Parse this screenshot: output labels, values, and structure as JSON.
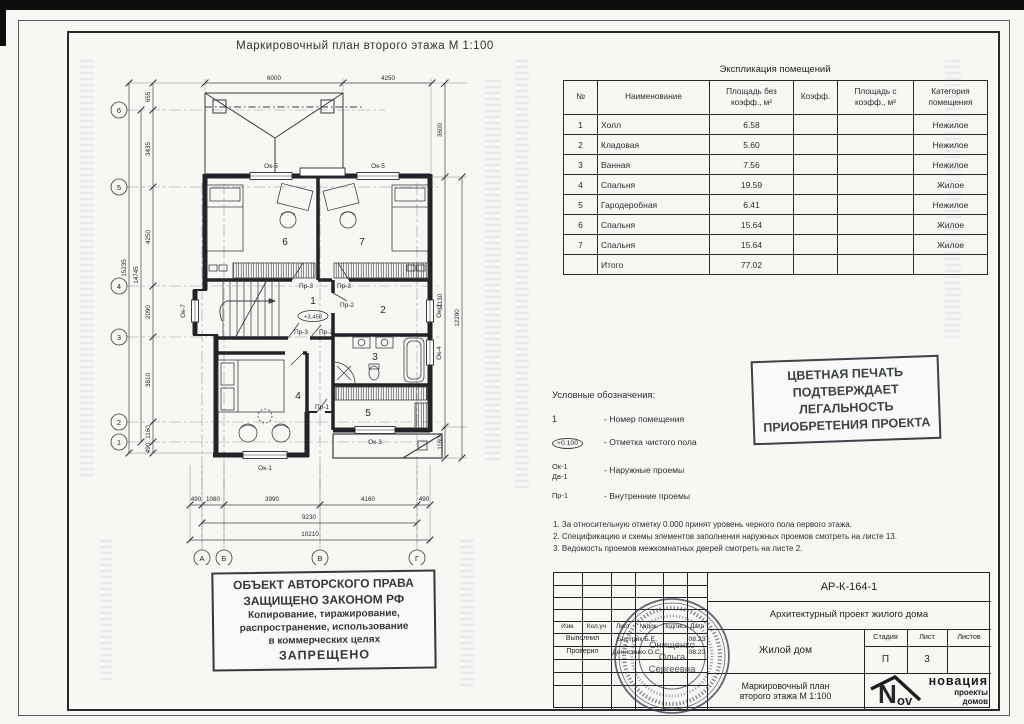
{
  "sheet": {
    "drawing_title": "Маркировочный  план  второго этажа  М 1:100"
  },
  "explication": {
    "title": "Экспликация помещений",
    "headers": {
      "num": "№",
      "name": "Наименование",
      "area_wo": "Площадь без коэфф., м²",
      "coef": "Коэфф.",
      "area_w": "Площадь с коэфф., м²",
      "category": "Категория помещения"
    },
    "rows": [
      {
        "num": "1",
        "name": "Холл",
        "area": "6.58",
        "category": "Нежилое"
      },
      {
        "num": "2",
        "name": "Кладовая",
        "area": "5.60",
        "category": "Нежилое"
      },
      {
        "num": "3",
        "name": "Ванная",
        "area": "7.56",
        "category": "Нежилое"
      },
      {
        "num": "4",
        "name": "Спальня",
        "area": "19.59",
        "category": "Жилое"
      },
      {
        "num": "5",
        "name": "Гародеробная",
        "area": "6.41",
        "category": "Нежилое"
      },
      {
        "num": "6",
        "name": "Спальня",
        "area": "15.64",
        "category": "Жилое"
      },
      {
        "num": "7",
        "name": "Спальня",
        "area": "15.64",
        "category": "Жилое"
      },
      {
        "num": "",
        "name": "Итого",
        "area": "77.02",
        "category": ""
      }
    ]
  },
  "legend": {
    "title": "Условные обозначения:",
    "item1_sym": "1",
    "item1_text": "- Номер помещения",
    "item2_sym": "+0.100",
    "item2_text": "- Отметка чистого пола",
    "item3_sym1": "Ок-1",
    "item3_sym2": "Дв-1",
    "item3_text": "- Наружные проемы",
    "item4_sym": "Пр-1",
    "item4_text": "- Внутренние проемы"
  },
  "notes": {
    "n1": "1. За относительную отметку 0.000 принят уровень черного пола первого этажа.",
    "n2": "2. Спецификацию и схемы элементов заполнения наружных проемов смотреть на листе 13.",
    "n3": "3. Ведомость проемов межкомнатных дверей смотреть на листе 2."
  },
  "color_stamp": {
    "l1": "ЦВЕТНАЯ ПЕЧАТЬ",
    "l2": "ПОДТВЕРЖДАЕТ",
    "l3": "ЛЕГАЛЬНОСТЬ",
    "l4": "ПРИОБРЕТЕНИЯ ПРОЕКТА"
  },
  "copyright_stamp": {
    "l1": "ОБЪЕКТ АВТОРСКОГО ПРАВА",
    "l2": "ЗАЩИЩЕНО ЗАКОНОМ РФ",
    "l3": "Копирование, тиражирование,",
    "l4": "распространение, использование",
    "l5": "в коммерческих целях",
    "l6": "ЗАПРЕЩЕНО"
  },
  "titleblock": {
    "doc_code": "АР-К-164-1",
    "project": "Архитектурный проект жилого дома",
    "object": "Жилой дом",
    "sheet_title_l1": "Маркировочный план",
    "sheet_title_l2": "второго этажа  М 1:100",
    "col_izm": "Изм.",
    "col_kol": "Кол.уч",
    "col_list": "Лист",
    "col_ndoc": "№док.",
    "col_podp": "Подпись",
    "col_data": "Дата",
    "row1_role": "Выполнил",
    "row1_name": "Бестрик Б.Е.",
    "row1_date": "08.23",
    "row2_role": "Проверил",
    "row2_name": "Денисенко О.С.",
    "row2_date": "08.23",
    "stage_h": "Стадия",
    "sheet_h": "Лист",
    "sheets_h": "Листов",
    "stage_v": "П",
    "sheet_no": "3",
    "sheets_total": "",
    "logo_big": "N",
    "logo_small": "ov",
    "logo_brand": "новация",
    "logo_sub1": "проекты",
    "logo_sub2": "домов"
  },
  "seal": {
    "name_l1": "Онищенко",
    "name_l2": "Ольга",
    "name_l3": "Сергеевна"
  },
  "plan": {
    "axes": {
      "v1": "6",
      "v2": "5",
      "v3": "4",
      "v4": "3",
      "v5": "2",
      "v6": "1",
      "h1": "А",
      "h2": "Б",
      "h3": "В",
      "h4": "Г"
    },
    "dims": {
      "t1": "6000",
      "t2": "4250",
      "l1": "655",
      "l2": "3435",
      "l3": "4250",
      "l4": "2090",
      "l5": "3810",
      "l6": "1160",
      "l7": "490",
      "lo1": "14745",
      "lo2": "15235",
      "r1": "3600",
      "r2": "11130",
      "r3": "1160",
      "r4": "12290",
      "b1": "490",
      "b2": "1080",
      "b3": "3990",
      "b4": "4160",
      "b5": "490",
      "b6": "9230",
      "b7": "10210"
    },
    "rooms": {
      "r1": "1",
      "r2": "2",
      "r3": "3",
      "r4": "4",
      "r5": "5",
      "r6": "6",
      "r7": "7"
    },
    "elevation": "+3.450",
    "openings": {
      "ok5a": "Ок-5",
      "ok5b": "Ок-5",
      "ok7": "Ок-7",
      "ok2": "Ок-2",
      "ok4": "Ок-4",
      "ok3": "Ок-3",
      "ok1": "Ок-1",
      "pr3a": "Пр-3",
      "pr3b": "Пр-3",
      "pr3c": "Пр-3",
      "pr2a": "Пр-2",
      "pr2b": "Пр-2",
      "pr1": "Пр-1"
    }
  }
}
